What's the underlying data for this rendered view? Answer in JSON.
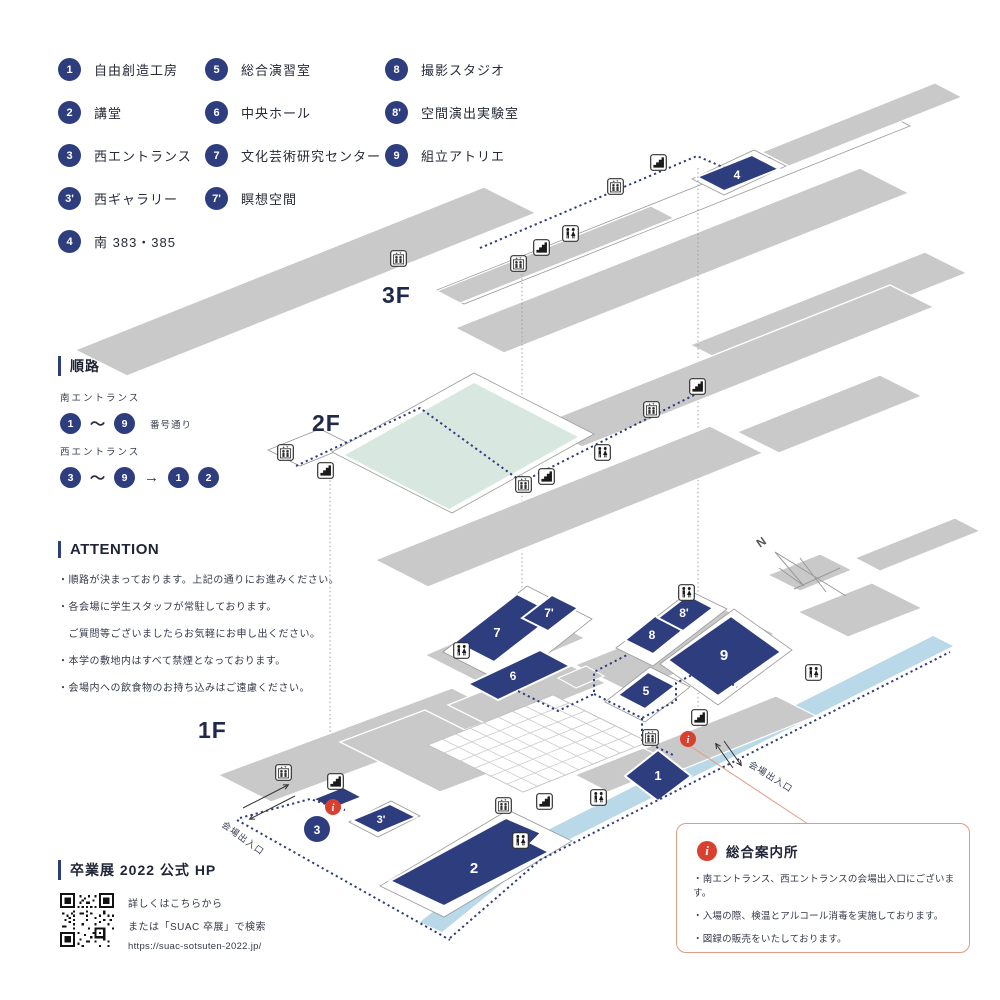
{
  "legend": {
    "items": [
      {
        "num": "1",
        "label": "自由創造工房"
      },
      {
        "num": "2",
        "label": "講堂"
      },
      {
        "num": "3",
        "label": "西エントランス"
      },
      {
        "num": "3'",
        "label": "西ギャラリー"
      },
      {
        "num": "4",
        "label": "南 383・385"
      },
      {
        "num": "5",
        "label": "総合演習室"
      },
      {
        "num": "6",
        "label": "中央ホール"
      },
      {
        "num": "7",
        "label": "文化芸術研究センター"
      },
      {
        "num": "7'",
        "label": "瞑想空間"
      },
      {
        "num": "8",
        "label": "撮影スタジオ"
      },
      {
        "num": "8'",
        "label": "空間演出実験室"
      },
      {
        "num": "9",
        "label": "組立アトリエ"
      }
    ]
  },
  "route": {
    "title": "順路",
    "tilde": "〜",
    "arrow": "→",
    "south": {
      "label": "南エントランス",
      "from": "1",
      "to": "9",
      "note": "番号通り"
    },
    "west": {
      "label": "西エントランス",
      "from": "3",
      "to": "9",
      "then": [
        "1",
        "2"
      ]
    }
  },
  "attention": {
    "title": "ATTENTION",
    "lines": [
      "・順路が決まっております。上記の通りにお進みください。",
      "・各会場に学生スタッフが常駐しております。",
      "　ご質問等ございましたらお気軽にお申し出ください。",
      "・本学の敷地内はすべて禁煙となっております。",
      "・会場内への飲食物のお持ち込みはご遠慮ください。"
    ]
  },
  "hp": {
    "title": "卒業展 2022 公式 HP",
    "line1": "詳しくはこちらから",
    "line2": "または「SUAC 卒展」で検索",
    "url": "https://suac-sotsuten-2022.jp/"
  },
  "info_box": {
    "icon_glyph": "i",
    "title": "総合案内所",
    "lines": [
      "・南エントランス、西エントランスの会場出入口にございます。",
      "・入場の際、検温とアルコール消毒を実施しております。",
      "・図録の販売をいたしております。"
    ]
  },
  "map": {
    "floors": {
      "f3": "3F",
      "f2": "2F",
      "f1": "1F"
    },
    "compass": "N",
    "entrance_west": "会場出入口",
    "entrance_south": "会場出入口",
    "info_glyph": "i",
    "rooms": {
      "r1": "1",
      "r2": "2",
      "r3": "3",
      "r3p": "3'",
      "r4": "4",
      "r5": "5",
      "r6": "6",
      "r7": "7",
      "r7p": "7'",
      "r8": "8",
      "r8p": "8'",
      "r9": "9"
    }
  },
  "colors": {
    "navy": "#2e3d7d",
    "floor_gray": "#c9c9c9",
    "mint": "#d8e8e1",
    "walkway": "#b9d8e8",
    "red": "#d8402f",
    "box_border": "#e39a84"
  }
}
